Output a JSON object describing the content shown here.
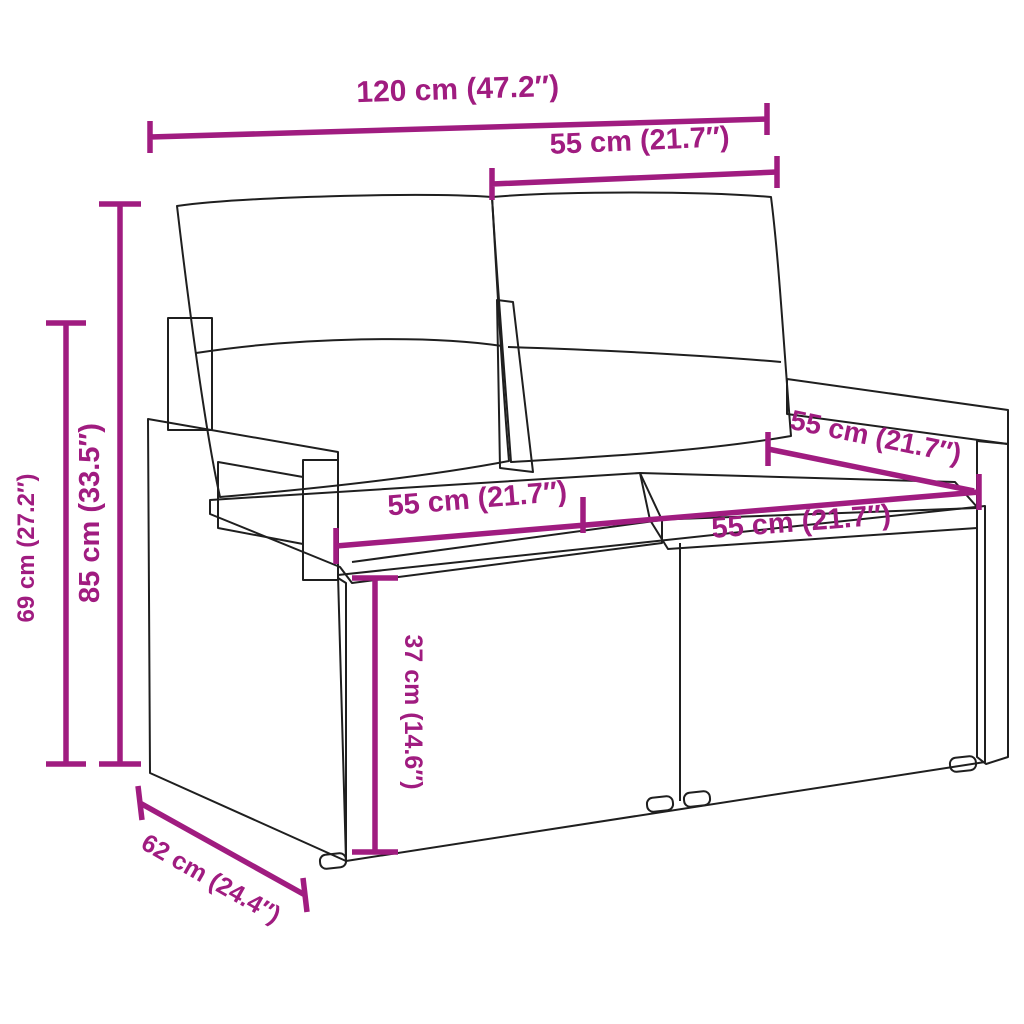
{
  "diagram": {
    "title": "garden-sofa-dimension-diagram",
    "product": "poly rattan 2-seater garden sofa with back and seat cushions",
    "colors": {
      "accent": "#A01C80",
      "outline": "#1f1f1f",
      "background": "#ffffff",
      "seat_cushion": "#f5f3ea",
      "back_cushion": "#ffffff"
    },
    "dimensions": [
      {
        "id": "overall-width",
        "label": "120 cm (47.2″)",
        "value_cm": 120,
        "value_in": 47.2
      },
      {
        "id": "backrest-width",
        "label": "55 cm (21.7″)",
        "value_cm": 55,
        "value_in": 21.7
      },
      {
        "id": "overall-height",
        "label": "85 cm (33.5″)",
        "value_cm": 85,
        "value_in": 33.5
      },
      {
        "id": "arm-height",
        "label": "69 cm (27.2″)",
        "value_cm": 69,
        "value_in": 27.2
      },
      {
        "id": "seat-width-left",
        "label": "55 cm (21.7″)",
        "value_cm": 55,
        "value_in": 21.7
      },
      {
        "id": "seat-width-right",
        "label": "55 cm (21.7″)",
        "value_cm": 55,
        "value_in": 21.7
      },
      {
        "id": "arm-depth",
        "label": "55 cm (21.7″)",
        "value_cm": 55,
        "value_in": 21.7
      },
      {
        "id": "seat-height",
        "label": "37 cm (14.6″)",
        "value_cm": 37,
        "value_in": 14.6
      },
      {
        "id": "overall-depth",
        "label": "62 cm (24.4″)",
        "value_cm": 62,
        "value_in": 24.4
      }
    ]
  }
}
